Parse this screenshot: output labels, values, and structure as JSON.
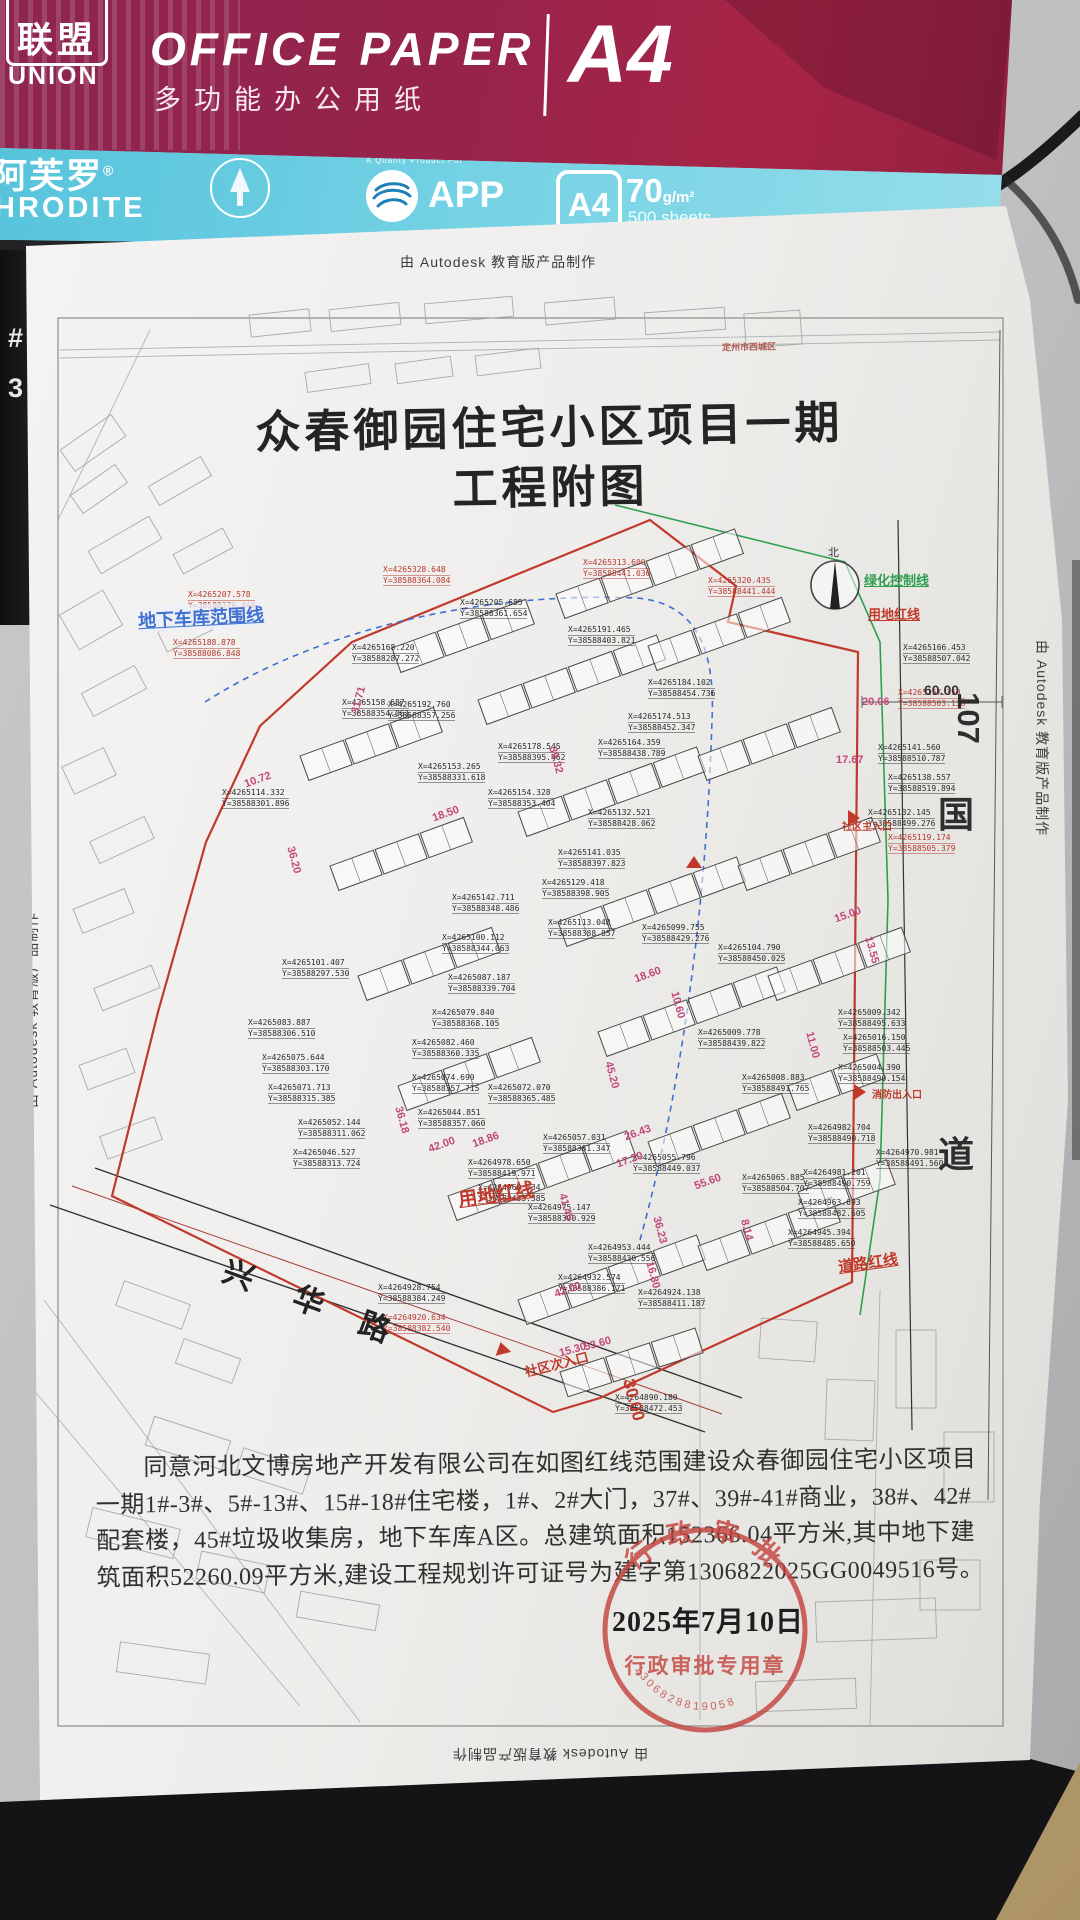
{
  "desk": {
    "key_hash": "#",
    "key_three": "3"
  },
  "ream": {
    "logo_chars": "联盟",
    "logo_sub": "UNION",
    "title_en": "OFFICE PAPER",
    "title_cn": "多功能办公用纸",
    "size_big": "A4",
    "brand_cn": "阿芙罗",
    "brand_reg": "®",
    "brand_en_partial": "HRODITE",
    "quality_note": "A Quality Product For",
    "app_label": "APP",
    "size_box": "A4",
    "weight_num": "70",
    "weight_unit": "g/m²",
    "sheets": "500 sheets"
  },
  "document": {
    "watermark": "由 Autodesk 教育版产品制作",
    "title_line1": "众春御园住宅小区项目一期",
    "title_line2": "工程附图",
    "approval_lines": [
      "同意河北文博房地产开发有限公司在如图红线范围建设众春御园住宅小区项目",
      "一期1#-3#、5#-13#、15#-18#住宅楼，1#、2#大门，37#、39#-41#商业，38#、42#",
      "配套楼，45#垃圾收集房，地下车库A区。总建筑面积152366.04平方米,其中地下建",
      "筑面积52260.09平方米,建设工程规划许可证号为建字第1306822025GG0049516号。"
    ],
    "date": "2025年7月10日",
    "stamp": {
      "arc_top": "行政审批",
      "center": "行政审批专用章",
      "code": "1306828819058"
    }
  },
  "plan": {
    "north_label": "北",
    "roads": {
      "xinghua": [
        "兴",
        "华",
        "路"
      ],
      "guodao_num": "107",
      "guodao_guo": "国",
      "guodao_dao": "道"
    },
    "labels": [
      {
        "t": "地下车库范围线",
        "x": 138,
        "y": 604,
        "s": 18,
        "c": "#3f6fd0",
        "r": -3,
        "u": 1,
        "bg": 1
      },
      {
        "t": "绿化控制线",
        "x": 864,
        "y": 570,
        "s": 13,
        "c": "#2f9e4f",
        "r": 0,
        "u": 1
      },
      {
        "t": "用地红线",
        "x": 868,
        "y": 604,
        "s": 13,
        "c": "#c0392b",
        "r": 0,
        "u": 1
      },
      {
        "t": "用地红线",
        "x": 458,
        "y": 1180,
        "s": 19,
        "c": "#c0392b",
        "r": -8,
        "u": 1
      },
      {
        "t": "道路红线",
        "x": 838,
        "y": 1252,
        "s": 15,
        "c": "#c0392b",
        "r": -8,
        "u": 1
      },
      {
        "t": "社区主入口",
        "x": 842,
        "y": 818,
        "s": 10,
        "c": "#c0392b",
        "r": 0
      },
      {
        "t": "消防出入口",
        "x": 872,
        "y": 1086,
        "s": 10,
        "c": "#c0392b",
        "r": 0
      },
      {
        "t": "社区次入口",
        "x": 524,
        "y": 1354,
        "s": 13,
        "c": "#c0392b",
        "r": -14
      },
      {
        "t": "定州市西城区",
        "x": 722,
        "y": 340,
        "s": 9,
        "c": "#b05a50",
        "r": -1
      }
    ],
    "triangles": [
      {
        "x": 494,
        "y": 1342,
        "r": -14
      },
      {
        "x": 852,
        "y": 1086,
        "r": 90
      },
      {
        "x": 846,
        "y": 812,
        "r": 90
      },
      {
        "x": 686,
        "y": 856,
        "r": 0
      }
    ],
    "dims": [
      {
        "v": "31.71",
        "x": 345,
        "y": 694,
        "r": -75
      },
      {
        "v": "18.50",
        "x": 432,
        "y": 808,
        "r": -20
      },
      {
        "v": "39.32",
        "x": 542,
        "y": 754,
        "r": 75
      },
      {
        "v": "36.20",
        "x": 280,
        "y": 854,
        "r": 75
      },
      {
        "v": "10.72",
        "x": 244,
        "y": 774,
        "r": -20
      },
      {
        "v": "36.18",
        "x": 388,
        "y": 1114,
        "r": 75
      },
      {
        "v": "42.00",
        "x": 428,
        "y": 1139,
        "r": -20
      },
      {
        "v": "42.00",
        "x": 554,
        "y": 1284,
        "r": -20
      },
      {
        "v": "18.86",
        "x": 472,
        "y": 1134,
        "r": -20
      },
      {
        "v": "26.43",
        "x": 624,
        "y": 1127,
        "r": -20
      },
      {
        "v": "45.20",
        "x": 598,
        "y": 1069,
        "r": 75
      },
      {
        "v": "10.60",
        "x": 664,
        "y": 999,
        "r": 75
      },
      {
        "v": "18.60",
        "x": 634,
        "y": 969,
        "r": -20
      },
      {
        "v": "15.00",
        "x": 834,
        "y": 909,
        "r": -20
      },
      {
        "v": "17.30",
        "x": 616,
        "y": 1154,
        "r": -20
      },
      {
        "v": "41.45",
        "x": 552,
        "y": 1201,
        "r": 75
      },
      {
        "v": "16.80",
        "x": 639,
        "y": 1269,
        "r": 75
      },
      {
        "v": "36.23",
        "x": 646,
        "y": 1224,
        "r": 75
      },
      {
        "v": "15.30",
        "x": 559,
        "y": 1344,
        "r": -15
      },
      {
        "v": "55.60",
        "x": 694,
        "y": 1176,
        "r": -20
      },
      {
        "v": "13.55",
        "x": 858,
        "y": 944,
        "r": 75
      },
      {
        "v": "53.60",
        "x": 584,
        "y": 1338,
        "r": -15
      },
      {
        "v": "8.14",
        "x": 736,
        "y": 1224,
        "r": 75
      },
      {
        "v": "11.00",
        "x": 799,
        "y": 1039,
        "r": 75
      },
      {
        "v": "20.06",
        "x": 862,
        "y": 696,
        "r": 0
      },
      {
        "v": "17.67",
        "x": 836,
        "y": 754,
        "r": 0
      },
      {
        "v": "30.00",
        "x": 612,
        "y": 1390,
        "r": 75,
        "c": "#c0392b",
        "s": 17
      },
      {
        "v": "60.00",
        "x": 924,
        "y": 682,
        "r": 0,
        "c": "#333333",
        "s": 14
      }
    ],
    "coords": [
      {
        "x": 460,
        "y": 598,
        "a": "4265205.685",
        "b": "38588361.654"
      },
      {
        "x": 568,
        "y": 625,
        "a": "4265191.465",
        "b": "38588403.821"
      },
      {
        "x": 648,
        "y": 678,
        "a": "4265184.102",
        "b": "38588454.736"
      },
      {
        "x": 628,
        "y": 712,
        "a": "4265174.513",
        "b": "38588452.347"
      },
      {
        "x": 388,
        "y": 700,
        "a": "4265192.760",
        "b": "38588357.256"
      },
      {
        "x": 498,
        "y": 742,
        "a": "4265178.545",
        "b": "38588395.462"
      },
      {
        "x": 418,
        "y": 762,
        "a": "4265153.265",
        "b": "38588331.618"
      },
      {
        "x": 488,
        "y": 788,
        "a": "4265154.328",
        "b": "38588353.404"
      },
      {
        "x": 598,
        "y": 738,
        "a": "4265164.359",
        "b": "38588438.789"
      },
      {
        "x": 588,
        "y": 808,
        "a": "4265132.521",
        "b": "38588428.062"
      },
      {
        "x": 558,
        "y": 848,
        "a": "4265141.035",
        "b": "38588397.823"
      },
      {
        "x": 542,
        "y": 878,
        "a": "4265129.418",
        "b": "38588398.905"
      },
      {
        "x": 452,
        "y": 893,
        "a": "4265142.711",
        "b": "38588348.486"
      },
      {
        "x": 548,
        "y": 918,
        "a": "4265113.048",
        "b": "38588388.857"
      },
      {
        "x": 442,
        "y": 933,
        "a": "4265100.112",
        "b": "38588344.063"
      },
      {
        "x": 642,
        "y": 923,
        "a": "4265099.755",
        "b": "38588429.276"
      },
      {
        "x": 718,
        "y": 943,
        "a": "4265104.790",
        "b": "38588450.025"
      },
      {
        "x": 448,
        "y": 973,
        "a": "4265087.187",
        "b": "38588339.704"
      },
      {
        "x": 432,
        "y": 1008,
        "a": "4265079.840",
        "b": "38588368.105"
      },
      {
        "x": 412,
        "y": 1038,
        "a": "4265082.460",
        "b": "38588360.335"
      },
      {
        "x": 282,
        "y": 958,
        "a": "4265101.407",
        "b": "38588297.530"
      },
      {
        "x": 248,
        "y": 1018,
        "a": "4265083.887",
        "b": "38588306.510"
      },
      {
        "x": 262,
        "y": 1053,
        "a": "4265075.644",
        "b": "38588303.170"
      },
      {
        "x": 268,
        "y": 1083,
        "a": "4265071.713",
        "b": "38588315.385"
      },
      {
        "x": 412,
        "y": 1073,
        "a": "4265074.690",
        "b": "38588357.715"
      },
      {
        "x": 488,
        "y": 1083,
        "a": "4265072.070",
        "b": "38588365.485"
      },
      {
        "x": 418,
        "y": 1108,
        "a": "4265044.851",
        "b": "38588357.060"
      },
      {
        "x": 298,
        "y": 1118,
        "a": "4265052.144",
        "b": "38588311.062"
      },
      {
        "x": 293,
        "y": 1148,
        "a": "4265046.527",
        "b": "38588313.724"
      },
      {
        "x": 543,
        "y": 1133,
        "a": "4265057.031",
        "b": "38588361.347"
      },
      {
        "x": 633,
        "y": 1153,
        "a": "4265055.796",
        "b": "38588449.037"
      },
      {
        "x": 742,
        "y": 1173,
        "a": "4265065.885",
        "b": "38588504.707"
      },
      {
        "x": 352,
        "y": 643,
        "a": "4265168.220",
        "b": "38588287.272"
      },
      {
        "x": 342,
        "y": 698,
        "a": "4265158.687",
        "b": "38588354.061"
      },
      {
        "x": 222,
        "y": 788,
        "a": "4265114.332",
        "b": "38588301.896"
      },
      {
        "x": 698,
        "y": 1028,
        "a": "4265009.778",
        "b": "38588439.822"
      },
      {
        "x": 742,
        "y": 1073,
        "a": "4265008.883",
        "b": "38588491.765"
      },
      {
        "x": 838,
        "y": 1008,
        "a": "4265009.342",
        "b": "38588495.633"
      },
      {
        "x": 843,
        "y": 1033,
        "a": "4265016.150",
        "b": "38588503.445"
      },
      {
        "x": 838,
        "y": 1063,
        "a": "4265004.390",
        "b": "38588490.154"
      },
      {
        "x": 808,
        "y": 1123,
        "a": "4264982.704",
        "b": "38588490.718"
      },
      {
        "x": 876,
        "y": 1148,
        "a": "4264970.981",
        "b": "38588491.560"
      },
      {
        "x": 803,
        "y": 1168,
        "a": "4264981.201",
        "b": "38588490.759"
      },
      {
        "x": 798,
        "y": 1198,
        "a": "4264963.693",
        "b": "38588482.605"
      },
      {
        "x": 788,
        "y": 1228,
        "a": "4264945.394",
        "b": "38588485.650"
      },
      {
        "x": 468,
        "y": 1158,
        "a": "4264978.650",
        "b": "38588419.971"
      },
      {
        "x": 478,
        "y": 1183,
        "a": "4264963.034",
        "b": "38588433.385"
      },
      {
        "x": 528,
        "y": 1203,
        "a": "4264975.147",
        "b": "38588390.929"
      },
      {
        "x": 588,
        "y": 1243,
        "a": "4264953.444",
        "b": "38588430.556"
      },
      {
        "x": 558,
        "y": 1273,
        "a": "4264932.574",
        "b": "38588386.171"
      },
      {
        "x": 638,
        "y": 1288,
        "a": "4264924.138",
        "b": "38588411.187"
      },
      {
        "x": 378,
        "y": 1283,
        "a": "4264928.754",
        "b": "38588384.249"
      },
      {
        "x": 615,
        "y": 1393,
        "a": "4264890.180",
        "b": "38588472.453"
      },
      {
        "x": 903,
        "y": 643,
        "a": "4265166.453",
        "b": "38588507.042"
      },
      {
        "x": 878,
        "y": 743,
        "a": "4265141.560",
        "b": "38588510.787"
      },
      {
        "x": 888,
        "y": 773,
        "a": "4265138.557",
        "b": "38588519.894"
      },
      {
        "x": 868,
        "y": 808,
        "a": "4265132.145",
        "b": "38588499.276"
      },
      {
        "x": 383,
        "y": 565,
        "a": "4265328.648",
        "b": "38588364.084",
        "c": "r"
      },
      {
        "x": 583,
        "y": 558,
        "a": "4265313.600",
        "b": "38588441.036",
        "c": "r"
      },
      {
        "x": 708,
        "y": 576,
        "a": "4265320.435",
        "b": "38588441.444",
        "c": "r"
      },
      {
        "x": 188,
        "y": 590,
        "a": "4265207.578",
        "b": "38588376.448",
        "c": "r"
      },
      {
        "x": 173,
        "y": 638,
        "a": "4265188.878",
        "b": "38588086.848",
        "c": "r"
      },
      {
        "x": 888,
        "y": 833,
        "a": "4265119.174",
        "b": "38588505.379",
        "c": "r"
      },
      {
        "x": 898,
        "y": 688,
        "a": "4265157.350",
        "b": "38588503.136",
        "c": "r"
      },
      {
        "x": 383,
        "y": 1313,
        "a": "4264920.634",
        "b": "38588382.540",
        "c": "r"
      }
    ]
  },
  "buildings": {
    "chains": [
      {
        "x": 392,
        "y": 648,
        "n": 3,
        "r": -20
      },
      {
        "x": 556,
        "y": 594,
        "n": 4,
        "r": -20
      },
      {
        "x": 300,
        "y": 756,
        "n": 3,
        "r": -20
      },
      {
        "x": 478,
        "y": 700,
        "n": 4,
        "r": -20
      },
      {
        "x": 648,
        "y": 646,
        "n": 3,
        "r": -20
      },
      {
        "x": 330,
        "y": 866,
        "n": 3,
        "r": -20
      },
      {
        "x": 518,
        "y": 812,
        "n": 4,
        "r": -20
      },
      {
        "x": 698,
        "y": 756,
        "n": 3,
        "r": -20
      },
      {
        "x": 358,
        "y": 976,
        "n": 3,
        "r": -20
      },
      {
        "x": 558,
        "y": 922,
        "n": 4,
        "r": -20
      },
      {
        "x": 738,
        "y": 866,
        "n": 3,
        "r": -20
      },
      {
        "x": 398,
        "y": 1086,
        "n": 3,
        "r": -20
      },
      {
        "x": 598,
        "y": 1032,
        "n": 4,
        "r": -20
      },
      {
        "x": 768,
        "y": 976,
        "n": 3,
        "r": -20
      },
      {
        "x": 448,
        "y": 1196,
        "n": 4,
        "r": -20
      },
      {
        "x": 648,
        "y": 1142,
        "n": 3,
        "r": -20
      },
      {
        "x": 788,
        "y": 1086,
        "n": 2,
        "r": -20
      },
      {
        "x": 518,
        "y": 1300,
        "n": 4,
        "r": -20
      },
      {
        "x": 698,
        "y": 1246,
        "n": 3,
        "r": -20
      },
      {
        "x": 798,
        "y": 1192,
        "n": 2,
        "r": -20
      },
      {
        "x": 560,
        "y": 1372,
        "n": 3,
        "r": -18
      }
    ]
  },
  "parcels": [
    {
      "x": 62,
      "y": 430,
      "w": 62,
      "h": 26,
      "r": -35
    },
    {
      "x": 72,
      "y": 478,
      "w": 54,
      "h": 22,
      "r": -35
    },
    {
      "x": 90,
      "y": 532,
      "w": 70,
      "h": 26,
      "r": -30
    },
    {
      "x": 66,
      "y": 600,
      "w": 50,
      "h": 40,
      "r": -30
    },
    {
      "x": 84,
      "y": 678,
      "w": 60,
      "h": 26,
      "r": -28
    },
    {
      "x": 66,
      "y": 756,
      "w": 46,
      "h": 30,
      "r": -25
    },
    {
      "x": 92,
      "y": 828,
      "w": 60,
      "h": 24,
      "r": -25
    },
    {
      "x": 76,
      "y": 898,
      "w": 55,
      "h": 26,
      "r": -22
    },
    {
      "x": 96,
      "y": 976,
      "w": 62,
      "h": 24,
      "r": -22
    },
    {
      "x": 82,
      "y": 1056,
      "w": 50,
      "h": 26,
      "r": -20
    },
    {
      "x": 102,
      "y": 1126,
      "w": 58,
      "h": 24,
      "r": -20
    },
    {
      "x": 150,
      "y": 470,
      "w": 60,
      "h": 22,
      "r": -30
    },
    {
      "x": 175,
      "y": 540,
      "w": 56,
      "h": 22,
      "r": -28
    },
    {
      "x": 160,
      "y": 620,
      "w": 50,
      "h": 22,
      "r": -26
    },
    {
      "x": 250,
      "y": 312,
      "w": 60,
      "h": 22,
      "r": -6
    },
    {
      "x": 330,
      "y": 306,
      "w": 70,
      "h": 22,
      "r": -6
    },
    {
      "x": 425,
      "y": 300,
      "w": 88,
      "h": 20,
      "r": -5
    },
    {
      "x": 545,
      "y": 300,
      "w": 70,
      "h": 22,
      "r": -5
    },
    {
      "x": 645,
      "y": 310,
      "w": 80,
      "h": 22,
      "r": -4
    },
    {
      "x": 745,
      "y": 312,
      "w": 56,
      "h": 34,
      "r": -4
    },
    {
      "x": 306,
      "y": 368,
      "w": 64,
      "h": 20,
      "r": -8
    },
    {
      "x": 396,
      "y": 360,
      "w": 56,
      "h": 20,
      "r": -8
    },
    {
      "x": 476,
      "y": 352,
      "w": 64,
      "h": 20,
      "r": -7
    },
    {
      "x": 118,
      "y": 1292,
      "w": 70,
      "h": 26,
      "r": 20
    },
    {
      "x": 178,
      "y": 1348,
      "w": 60,
      "h": 26,
      "r": 20
    },
    {
      "x": 148,
      "y": 1428,
      "w": 80,
      "h": 30,
      "r": 18
    },
    {
      "x": 238,
      "y": 1458,
      "w": 70,
      "h": 26,
      "r": 18
    },
    {
      "x": 88,
      "y": 1518,
      "w": 90,
      "h": 30,
      "r": 14
    },
    {
      "x": 198,
      "y": 1558,
      "w": 70,
      "h": 28,
      "r": 12
    },
    {
      "x": 298,
      "y": 1598,
      "w": 80,
      "h": 26,
      "r": 10
    },
    {
      "x": 118,
      "y": 1648,
      "w": 90,
      "h": 30,
      "r": 8
    },
    {
      "x": 760,
      "y": 1320,
      "w": 56,
      "h": 40,
      "r": 4
    },
    {
      "x": 826,
      "y": 1380,
      "w": 48,
      "h": 60,
      "r": 2
    },
    {
      "x": 896,
      "y": 1330,
      "w": 40,
      "h": 78,
      "r": 0
    },
    {
      "x": 944,
      "y": 1432,
      "w": 50,
      "h": 70,
      "r": 0
    },
    {
      "x": 816,
      "y": 1600,
      "w": 120,
      "h": 40,
      "r": -2
    },
    {
      "x": 756,
      "y": 1680,
      "w": 100,
      "h": 30,
      "r": -2
    },
    {
      "x": 920,
      "y": 1560,
      "w": 60,
      "h": 50,
      "r": 0
    }
  ]
}
